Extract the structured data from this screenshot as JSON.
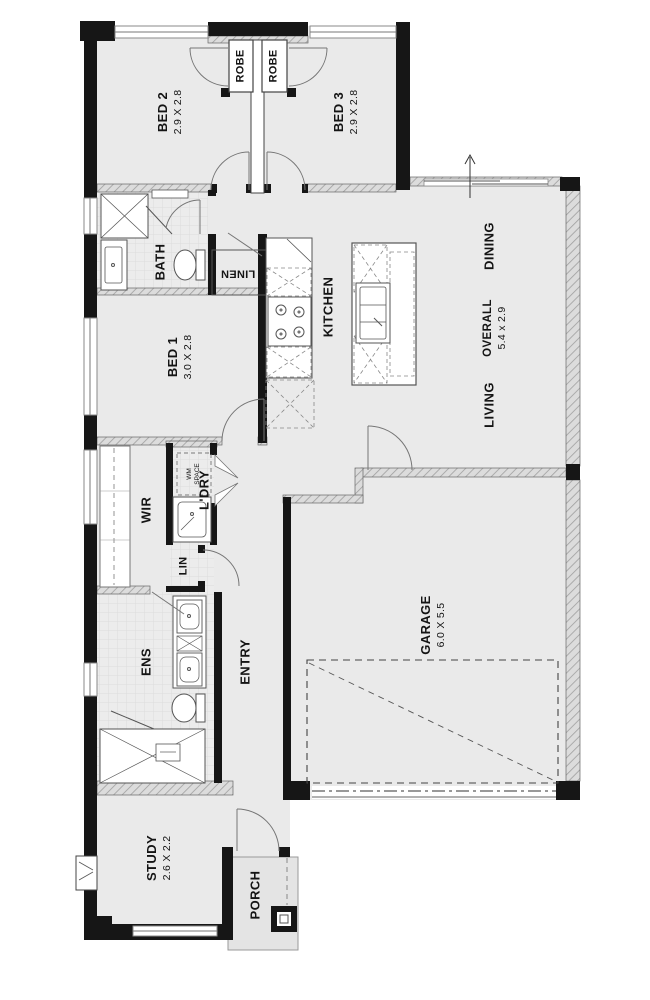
{
  "title": "Residential floor plan",
  "colors": {
    "floor": "#eaeaea",
    "wall_black": "#161616",
    "line": "#555555",
    "arc": "#757575"
  },
  "rooms": {
    "bed2": {
      "label": "BED 2",
      "dims": "2.9 X 2.8"
    },
    "bed3": {
      "label": "BED 3",
      "dims": "2.9 X 2.8"
    },
    "robe1": {
      "label": "ROBE"
    },
    "robe2": {
      "label": "ROBE"
    },
    "bath": {
      "label": "BATH"
    },
    "linen": {
      "label": "LINEN"
    },
    "kitchen": {
      "label": "KITCHEN"
    },
    "dining": {
      "label": "DINING"
    },
    "overall": {
      "label": "OVERALL",
      "dims": "5.4 x 2.9"
    },
    "living": {
      "label": "LIVING"
    },
    "bed1": {
      "label": "BED 1",
      "dims": "3.0 X 2.8"
    },
    "wir": {
      "label": "WIR"
    },
    "ldry": {
      "label": "L'DRY"
    },
    "wm": {
      "label": "WM",
      "label2": "SPACE"
    },
    "lin": {
      "label": "LIN"
    },
    "ens": {
      "label": "ENS"
    },
    "entry": {
      "label": "ENTRY"
    },
    "garage": {
      "label": "GARAGE",
      "dims": "6.0 X 5.5"
    },
    "study": {
      "label": "STUDY",
      "dims": "2.6 X 2.2"
    },
    "porch": {
      "label": "PORCH"
    }
  }
}
